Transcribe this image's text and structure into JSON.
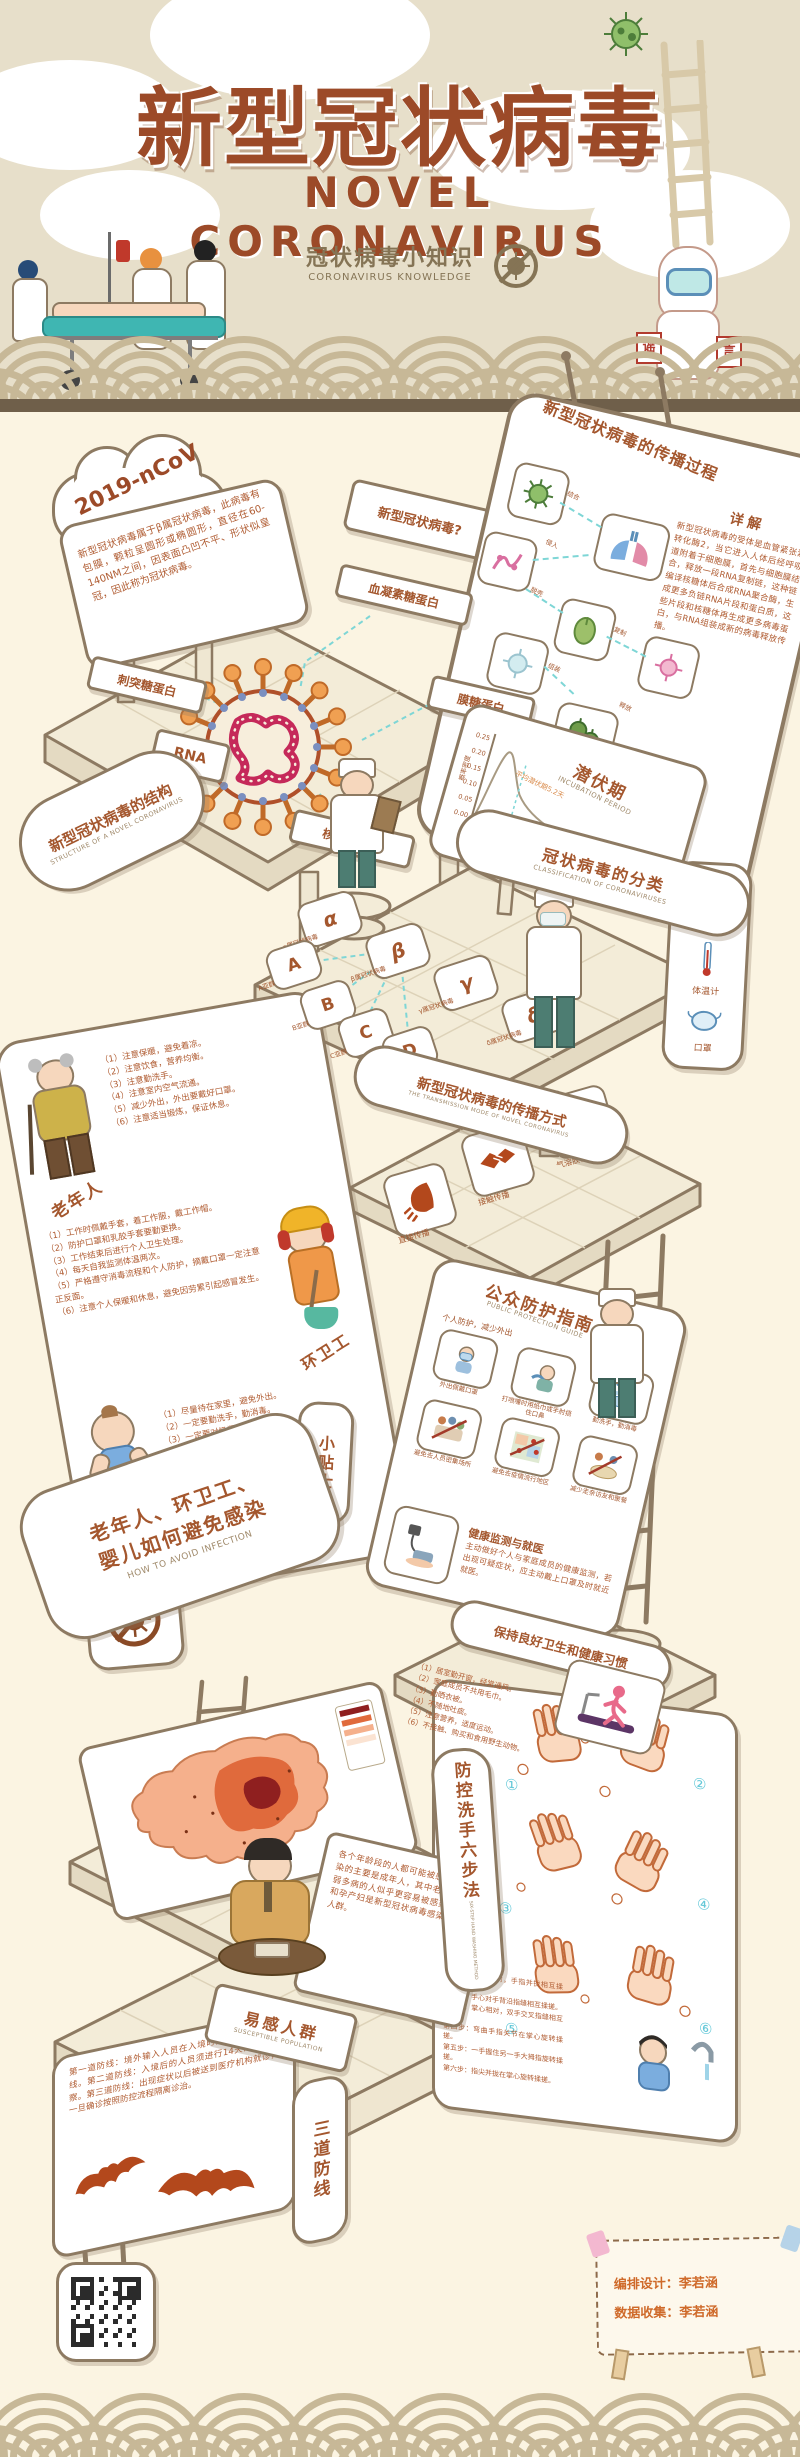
{
  "palette": {
    "background": "#fbf4e2",
    "header_band": "#e7dfca",
    "arc": "#c7b897",
    "saw": "#6f5f4a",
    "title_brown": "#9c4a28",
    "accent_rust": "#b3481c",
    "line_brown": "#8d7a62",
    "platform": "#f3ecd8",
    "cyan_dash": "#7ed6d6",
    "virus_orange": "#ec9a4a",
    "rna_pink": "#c5295a",
    "credit_orange": "#cf6a2a"
  },
  "header": {
    "title_cn": "新型冠状病毒",
    "title_en": "NOVEL CORONAVIRUS",
    "subtitle_cn": "冠状病毒小知识",
    "subtitle_en": "CORONAVIRUS KNOWLEDGE",
    "rumor_left": "谣",
    "rumor_right": "言"
  },
  "intro": {
    "cloud_label": "2019-nCoV",
    "board_text": "新型冠状病毒属于β属冠状病毒，此病毒有包膜，颗粒呈圆形或椭圆形，直径在60-140NM之间，因表面凸凹不平、形状似皇冠，因此称为冠状病毒。",
    "question_sign": "新型冠状病毒?"
  },
  "structure": {
    "sign_cn": "新型冠状病毒的结构",
    "sign_en": "STRUCTURE OF A NOVEL CORONAVIRUS",
    "label_top": "血凝素糖蛋白",
    "label_left": "刺突糖蛋白",
    "label_rna": "RNA",
    "label_right": "膜糖蛋白",
    "label_bottom": "核衣壳蛋白"
  },
  "process": {
    "title": "新型冠状病毒的传播过程",
    "detail_title": "详解",
    "detail_text": "新型冠状病毒的受体是血管紧张素转化酶2，当它进入人体后经呼吸道附着于细胞膜，首先与细胞膜结合，释放一段RNA复制链，这种链编译核糖体后合成RNA聚合酶，生成更多负链RNA片段和蛋白质，这些片段和核糖体再生成更多病毒蛋白，与RNA组装成新的病毒释放传播。",
    "steps": [
      "结合",
      "侵入",
      "脱壳",
      "复制",
      "组装",
      "释放"
    ]
  },
  "incubation": {
    "title_cn": "潜伏期",
    "title_en": "INCUBATION PERIOD",
    "avg_label": "平均潜伏期5.2天",
    "ylabel": "概率密度",
    "xlabel": "从感染至发病时间（天）",
    "chart": {
      "type": "area",
      "x": [
        0,
        1,
        2,
        3,
        4,
        5,
        6,
        8,
        10,
        14,
        18,
        21
      ],
      "y": [
        0.0,
        0.02,
        0.09,
        0.17,
        0.22,
        0.21,
        0.17,
        0.11,
        0.07,
        0.03,
        0.01,
        0.0
      ],
      "yticks": [
        "0.25",
        "0.20",
        "0.15",
        "0.10",
        "0.05",
        "0.00"
      ],
      "xticks": [
        "0",
        "7",
        "14",
        "21"
      ],
      "mean_x": 5.2
    }
  },
  "classification": {
    "sign_cn": "冠状病毒的分类",
    "sign_en": "CLASSIFICATION OF CORONAVIRUSES",
    "genera": [
      {
        "letter": "α",
        "label": "α属冠状病毒"
      },
      {
        "letter": "β",
        "label": "β属冠状病毒"
      },
      {
        "letter": "γ",
        "label": "γ属冠状病毒"
      },
      {
        "letter": "δ",
        "label": "δ属冠状病毒"
      }
    ],
    "subgroups": [
      {
        "letter": "A",
        "label": "A亚群"
      },
      {
        "letter": "B",
        "label": "B亚群"
      },
      {
        "letter": "C",
        "label": "C亚群"
      },
      {
        "letter": "D",
        "label": "D亚群"
      }
    ]
  },
  "supplies": {
    "items": [
      {
        "label": "消毒液"
      },
      {
        "label": "体温计"
      },
      {
        "label": "口罩"
      }
    ]
  },
  "transmission": {
    "sign_cn": "新型冠状病毒的传播方式",
    "sign_en": "THE TRANSMISSION MODE OF NOVEL CORONAVIRUS",
    "modes": [
      {
        "label": "直接传播"
      },
      {
        "label": "接触传播"
      },
      {
        "label": "气溶胶传播"
      }
    ]
  },
  "avoid": {
    "sign_cn_1": "老年人、环卫工、",
    "sign_cn_2": "婴儿如何避免感染",
    "sign_en": "HOW TO AVOID INFECTION",
    "tips_sign": "小贴士",
    "elderly": {
      "name": "老年人",
      "tips": [
        "（1）注意保暖，避免着凉。",
        "（2）注意饮食，营养均衡。",
        "（3）注意勤洗手。",
        "（4）注意室内空气流通。",
        "（5）减少外出，外出要戴好口罩。",
        "（6）注意适当锻炼，保证休息。"
      ]
    },
    "cleaner": {
      "name": "环卫工",
      "tips": [
        "（1）工作时佩戴手套，着工作服，戴工作帽。",
        "（2）防护口罩和乳胶手套要勤更换。",
        "（3）工作结束后进行个人卫生处理。",
        "（4）每天自我监测体温两次。",
        "（5）严格遵守消毒流程和个人防护，摘戴口罩一定注意正反面。",
        "（6）注意个人保暖和休息，避免因劳累引起感冒发生。"
      ]
    },
    "baby": {
      "name": "婴儿",
      "tips": [
        "（1）尽量待在家里，避免外出。",
        "（2）一定要勤洗手，勤消毒。",
        "（3）一定要对奶瓶进行消毒杀菌。",
        "（4）一定要注意添衣保暖，以防感冒。",
        "（5）外出一定要戴好口罩。",
        "（6）一定要吃熟食，少喝冷的饮料。"
      ]
    }
  },
  "guide": {
    "title_cn": "公众防护指南",
    "title_en": "PUBLIC PROTECTION GUIDE",
    "section1": "个人防护，减少外出",
    "tiles": [
      {
        "caption": "外出佩戴口罩"
      },
      {
        "caption": "打喷嚏时用纸巾或手肘捂住口鼻"
      },
      {
        "caption": "勤洗手，勤消毒"
      },
      {
        "caption": "避免去人员密集场所"
      },
      {
        "caption": "避免去疫情流行地区"
      },
      {
        "caption": "减少走亲访友和聚餐"
      }
    ],
    "monitor_title": "健康监测与就医",
    "monitor_text": "主动做好个人与家庭成员的健康监测，若出现可疑症状，应主动戴上口罩及时就近就医。"
  },
  "hygiene": {
    "title": "保持良好卫生和健康习惯",
    "tips": [
      "（1）居室勤开窗，经常通风。",
      "（2）家庭成员不共用毛巾。",
      "（3）勤晒衣被。",
      "（4）不随地吐痰。",
      "（5）注意营养，适度运动。",
      "（6）不接触、购买和食用野生动物。"
    ]
  },
  "handwash": {
    "sign_cn": "防控洗手六步法",
    "sign_en": "SIX-STEP HAND WASHING METHOD",
    "numbers": [
      "①",
      "②",
      "③",
      "④",
      "⑤",
      "⑥"
    ],
    "steps": [
      "第一步：掌心相对，手指并拢相互揉搓。",
      "第二步：手心对手背沿指缝相互揉搓。",
      "第三步：掌心相对，双手交叉指缝相互揉搓。",
      "第四步：弯曲手指关节在掌心旋转揉搓。",
      "第五步：一手握住另一手大拇指旋转揉搓。",
      "第六步：指尖并拢在掌心旋转揉搓。"
    ]
  },
  "susceptible": {
    "sign_cn": "易感人群",
    "sign_en": "SUSCEPTIBLE POPULATION",
    "text": "各个年龄段的人都可能被感染，被感染的主要是成年人，其中老年人和体弱多病的人似乎更容易被感染。儿童和孕产妇是新型冠状病毒感染的高危人群。"
  },
  "defense": {
    "sign": "三道防线",
    "text": "第一道防线：境外输入人员在入境时接受海关检疫防线。第二道防线：入境后的人员须进行14天的隔离观察。第三道防线：出现症状以后被送到医疗机构就诊，一旦确诊按照防控流程隔离诊治。"
  },
  "footer": {
    "credit_design": "编排设计：李若涵",
    "credit_data": "数据收集：李若涵"
  }
}
